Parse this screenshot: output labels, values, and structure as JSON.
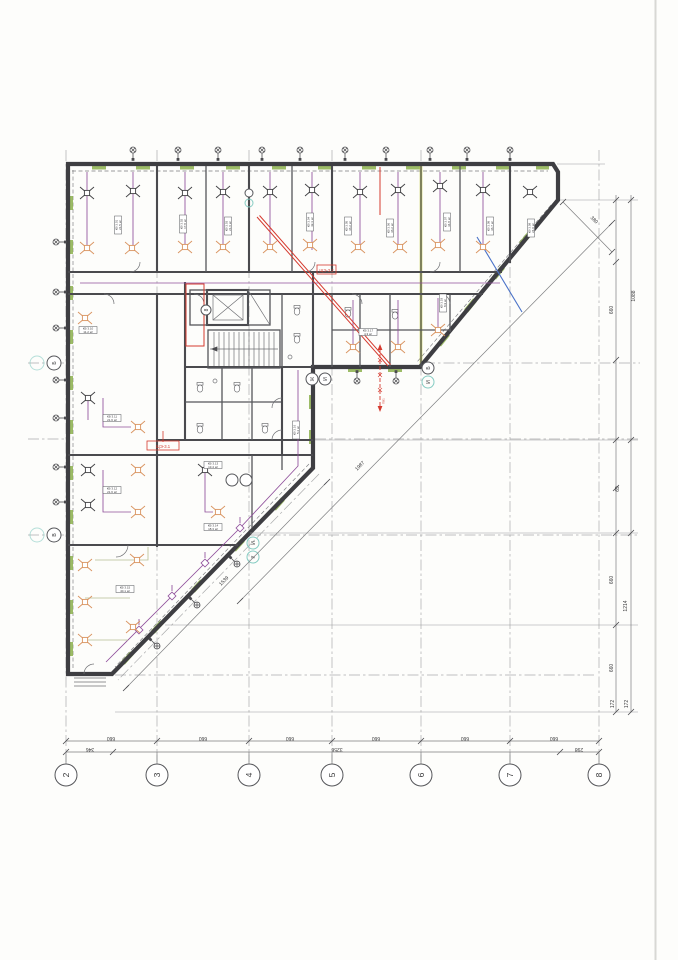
{
  "drawing": {
    "type": "floor-plan",
    "discipline": "electrical-lighting"
  },
  "grid": {
    "columns": [
      "2",
      "3",
      "4",
      "5",
      "6",
      "7",
      "8"
    ],
    "rows": [
      "Б",
      "В"
    ],
    "aux": [
      "Ж",
      "И",
      "Б",
      "И",
      "К",
      "8"
    ]
  },
  "dimensions": {
    "bottom_spans": [
      "660",
      "660",
      "660",
      "660",
      "660",
      "660"
    ],
    "bottom_chain": [
      "346",
      "3256",
      "298"
    ],
    "right_inner": [
      "660",
      "69",
      "660",
      "660",
      "172",
      "172"
    ],
    "right_outer": [
      "1088",
      "1214"
    ],
    "corner_diagonal": "380",
    "diagonal_long": "1987",
    "diagonal_short": "1539"
  },
  "annotations": {
    "panel_tag": "ЩЭ-3.1",
    "panel_tag_2": "ЩЭ-3.2",
    "riser_label": "ПВ1"
  },
  "rooms": [
    {
      "id": "КВ 3.01",
      "area": "21.5 м²"
    },
    {
      "id": "КВ 3.02",
      "area": "17.8 м²"
    },
    {
      "id": "КВ 3.03",
      "area": "21.6 м²"
    },
    {
      "id": "КВ 3.04",
      "area": "42.3 м²"
    },
    {
      "id": "КВ 3.05",
      "area": "36.2 м²"
    },
    {
      "id": "КВ 3.06",
      "area": "36.2 м²"
    },
    {
      "id": "КВ 3.07",
      "area": "34.8 м²"
    },
    {
      "id": "КВ 3.08",
      "area": "36.7 м²"
    },
    {
      "id": "КВ 3.09",
      "area": "24.0 м²"
    },
    {
      "id": "КВ 3.10",
      "area": "11.2 м²"
    },
    {
      "id": "КВ 3.11",
      "area": "21.6 м²"
    },
    {
      "id": "КВ 3.12",
      "area": "21.6 м²"
    },
    {
      "id": "КВ 3.13",
      "area": "13.4 м²"
    },
    {
      "id": "КВ 3.14",
      "area": "18.3 м²"
    },
    {
      "id": "КВ 3.15",
      "area": "40.1 м²"
    },
    {
      "id": "КВ 3.16",
      "area": "5.2 м²"
    },
    {
      "id": "КВ 3.17",
      "area": "4.3 м²"
    },
    {
      "id": "КВ 3.18",
      "area": "8.9 м²"
    }
  ],
  "colors": {
    "wall": "#3e3e42",
    "window_mark": "#8cb04c",
    "highlight_line": "#c9cf52",
    "wiring": "#8f4f9b",
    "markup_red": "#d53a2f",
    "markup_blue": "#4a72c8",
    "light_secondary": "#d9935f",
    "bubble_teal": "#86ccc3"
  }
}
